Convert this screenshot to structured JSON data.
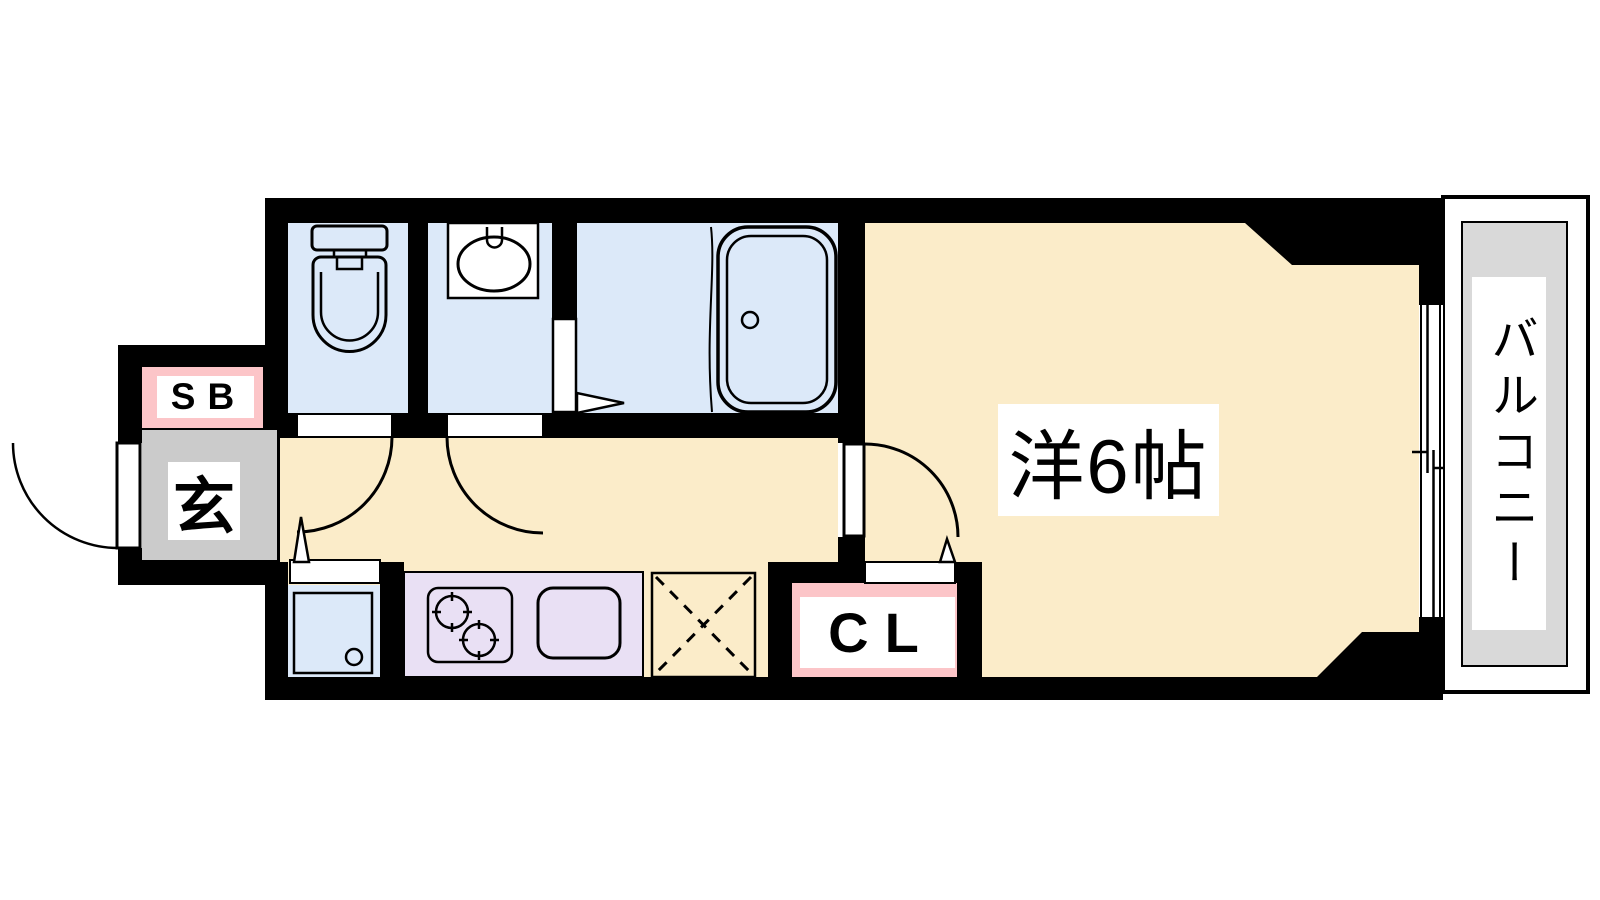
{
  "plan": {
    "type": "floor-plan",
    "labels": {
      "shoe_box": "SB",
      "entrance": "玄",
      "closet": "CL",
      "western_room": "洋6帖",
      "balcony": "バルコニー"
    },
    "rooms": [
      "entrance-genkan",
      "toilet",
      "washbasin-room",
      "bathroom",
      "kitchen-corridor",
      "western-room-6jo",
      "balcony",
      "closet",
      "shoe-box",
      "washing-machine-space",
      "refrigerator-space"
    ],
    "colors": {
      "wall": "#000000",
      "floor_cream": "#fbecc9",
      "wet_area_blue": "#dce9f9",
      "kitchen_purple": "#e9e0f4",
      "label_pink": "#fcc5c8",
      "entrance_gray": "#cbcbcb",
      "balcony_gray": "#d9d9d9"
    }
  }
}
